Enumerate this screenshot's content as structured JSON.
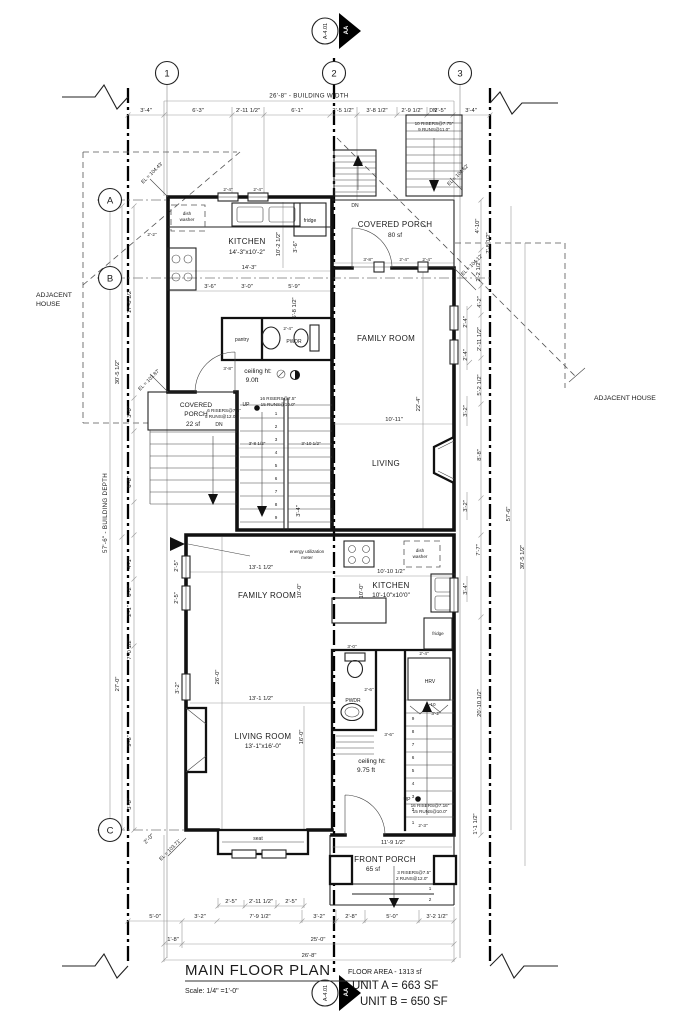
{
  "title_block": {
    "title": "MAIN FLOOR PLAN",
    "scale": "Scale: 1/4\" =1'-0\"",
    "floor_area": "FLOOR AREA - 1313 sf",
    "unit_a": "UNIT A = 663 SF",
    "unit_b": "UNIT B = 650 SF"
  },
  "section_marker": {
    "sheet": "A-4.01",
    "cut": "AA"
  },
  "grid": {
    "c1": "1",
    "c2": "2",
    "c3": "3",
    "rA": "A",
    "rB": "B",
    "rC": "C"
  },
  "context": {
    "adjacent_left_1": "ADJACENT",
    "adjacent_left_2": "HOUSE",
    "adjacent_right": "ADJACENT HOUSE",
    "building_width": "26'-8\" - BUILDING WIDTH",
    "building_depth": "57'-6\" - BUILDING DEPTH"
  },
  "labels": {
    "up": "UP",
    "dn": "DN",
    "seat": "seat"
  },
  "rooms": {
    "kitchen_a": {
      "name": "KITCHEN",
      "size": "14'-3\"x10'-2\""
    },
    "porch_a": {
      "name": "COVERED PORCH",
      "size": "80 sf"
    },
    "family_a": "FAMILY ROOM",
    "living_a": "LIVING",
    "pantry": "pantry",
    "pwdr_a": "PWDR",
    "ceiling_a_1": "ceiling ht:",
    "ceiling_a_2": "9.0ft",
    "porch_left_1": "COVERED",
    "porch_left_2": "PORCH",
    "porch_left_3": "22 sf",
    "family_b": "FAMILY ROOM",
    "kitchen_b": {
      "name": "KITCHEN",
      "size": "10'-10\"x10'0\""
    },
    "living_b": {
      "name": "LIVING ROOM",
      "size": "13'-1\"x16'-0\""
    },
    "pwdr_b": "PWDR",
    "ceiling_b_1": "ceiling ht:",
    "ceiling_b_2": "9.75 ft",
    "front_porch": {
      "name": "FRONT PORCH",
      "size": "65 sf"
    },
    "hrv": "HRV"
  },
  "appliances": {
    "dish_1": "dish",
    "dish_2": "washer",
    "fridge": "fridge",
    "meter_1": "energy utilization",
    "meter_2": "meter"
  },
  "stairs": {
    "tr_1": "10 RISERS@7.75\"",
    "tr_2": "9 RUNS@11.0\"",
    "mid_1": "16 RISERS@7.5\"",
    "mid_2": "15 RUNS@10.0\"",
    "lp_1": "6 RISERS@7.5\"",
    "lp_2": "5 RUNS@12.0\"",
    "ub_1": "16 RISERS@7.16\"",
    "ub_2": "15 RUNS@10.0\"",
    "fp_1": "3 RISERS@7.5\"",
    "fp_2": "2 RUNS@12.0\""
  },
  "elevations": {
    "e1": "EL = 104.43'",
    "e2": "EL = 104.62'",
    "e3": "EL = 104.12'",
    "e4": "EL = 103.87'",
    "e5": "EL = 103.71'"
  },
  "steps": [
    "1",
    "2",
    "3",
    "4",
    "5",
    "6",
    "7",
    "8",
    "9",
    "10"
  ],
  "dims": {
    "top": [
      "3'-4\"",
      "6'-3\"",
      "2'-11 1/2\"",
      "6'-1\"",
      "2'-5 1/2\"",
      "3'-8 1/2\"",
      "2'-9 1/2\"",
      "2'-5\"",
      "3'-4\""
    ],
    "bottom1": [
      "2'-5\"",
      "2'-11 1/2\"",
      "2'-5\""
    ],
    "bottom2": [
      "5'-0\"",
      "3'-2\"",
      "7'-9 1/2\"",
      "3'-2\"",
      "2'-8\"",
      "5'-0\"",
      "3'-2 1/2\""
    ],
    "bottom3": [
      "1'-8\"",
      "25'-0\""
    ],
    "bottom4": "26'-8\"",
    "left": [
      "17'-8 1/2\"",
      "30'-5 1/2\"",
      "3'-0\"",
      "6'-6\"",
      "4'-1\"",
      "6'-2\"",
      "2'-1\"",
      "7'-0 1/2\"",
      "27'-0\"",
      "9'-6\"",
      "3'-8\"",
      "2'-0\""
    ],
    "right": [
      "4'-10\"",
      "7'-8 1/2\"",
      "2'-2 1/2\"",
      "4'-2\"",
      "2'-4\"",
      "2'-11 1/2\"",
      "2'-4\"",
      "5'-2 1/2\"",
      "3'-2\"",
      "8'-8\"",
      "3'-2\"",
      "57'-6\"",
      "7'-7\"",
      "30'-5 1/2\"",
      "3'-4\"",
      "20'-10 1/2\"",
      "1'-1 1/2\""
    ],
    "side_yard_left": "2'-2\"",
    "win_top_1": "2'-4\"",
    "win_top_2": "2'-4\"",
    "ka_w": "14'-3\"",
    "ka_d": "10'-2 1/2\"",
    "ka_s1": "3'-6\"",
    "ka_s2": "3'-0\"",
    "ka_s3": "5'-9\"",
    "ka_s4": "3'-6\"",
    "ka_s5": "5'-8 1/2\"",
    "porch_a": [
      "3'-8\"",
      "2'-4\"",
      "2'-4\""
    ],
    "hall_door": "3'-8\"",
    "pwdr_a": "2'-4\"",
    "stair_mid": [
      "3'-8 1/2\"",
      "3'-10 1/2\"",
      "3'-4\""
    ],
    "fam_a_w": "10'-11\"",
    "fam_a_d": "22'-4\"",
    "fb_w1": "13'-1 1/2\"",
    "fb_w2": "13'-1 1/2\"",
    "fb_d": "26'-0\"",
    "lb_d": "16'-0\"",
    "kb_w": "10'-10 1/2\"",
    "kb_d1": "10'-0\"",
    "kb_d2": "10'-0\"",
    "win_left_b": [
      "2'-5\"",
      "2'-5\"",
      "3'-2\""
    ],
    "pwdr_b_1": "3'-0\"",
    "pwdr_b_2": "2'-6\"",
    "hrv_1": "2'-4\"",
    "hrv_2": "3'-2\"",
    "hall_b": "3'-6\"",
    "stair_b_1": "2'-3\"",
    "stair_b_2": "1'-1 1/2\"",
    "fp_w": "11'-9 1/2\""
  }
}
